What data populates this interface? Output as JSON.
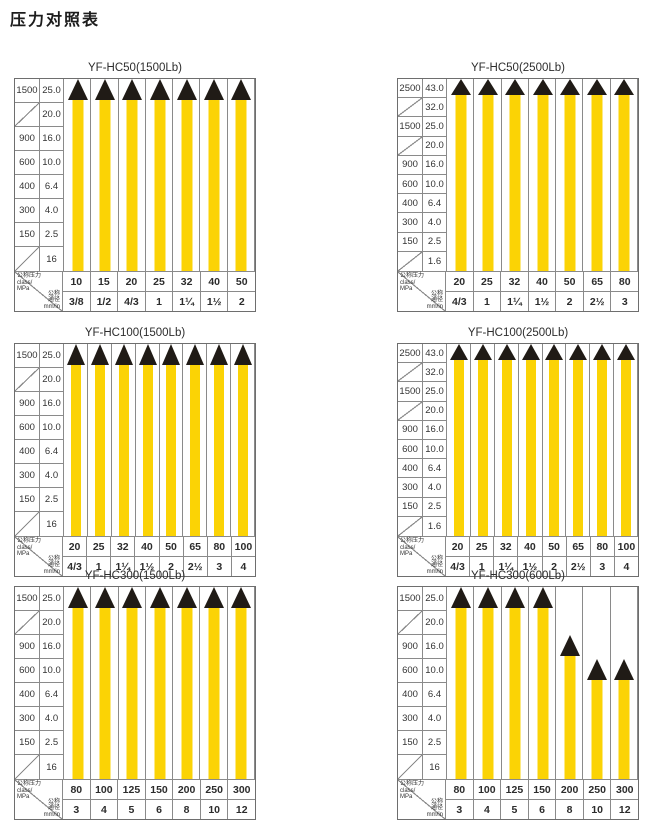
{
  "page": {
    "title": "压力对照表"
  },
  "corner": {
    "pressure_lines": [
      "公称压力",
      "class/",
      "MPa"
    ],
    "bore_lines": [
      "公称",
      "通径",
      "mm/in"
    ]
  },
  "colors": {
    "bar_yellow": "#FBD305",
    "marker_black": "#201B16",
    "grid_line": "#8A8A8A",
    "outer_border": "#6E6E6E"
  },
  "chart_data": [
    {
      "type": "bar",
      "title": "YF-HC50(1500Lb)",
      "ylabel": "公称压力 class / MPa",
      "xlabel": "公称通径 mm/in",
      "axis_rows": [
        [
          "1500",
          "25.0"
        ],
        [
          "",
          "20.0"
        ],
        [
          "900",
          "16.0"
        ],
        [
          "600",
          "10.0"
        ],
        [
          "400",
          "6.4"
        ],
        [
          "300",
          "4.0"
        ],
        [
          "150",
          "2.5"
        ],
        [
          "",
          "16"
        ]
      ],
      "categories": [
        "10",
        "15",
        "20",
        "25",
        "32",
        "40",
        "50"
      ],
      "dn_row": [
        "3/8",
        "1/2",
        "4/3",
        "1",
        "1¼",
        "1½",
        "2"
      ],
      "values_mpa": [
        25.0,
        25.0,
        25.0,
        25.0,
        25.0,
        25.0,
        25.0
      ],
      "bar_top_rows": [
        0,
        0,
        0,
        0,
        0,
        0,
        0
      ],
      "ylim": [
        0,
        25.0
      ]
    },
    {
      "type": "bar",
      "title": "YF-HC50(2500Lb)",
      "ylabel": "公称压力 class / MPa",
      "xlabel": "公称通径 mm/in",
      "axis_rows": [
        [
          "2500",
          "43.0"
        ],
        [
          "",
          "32.0"
        ],
        [
          "1500",
          "25.0"
        ],
        [
          "",
          "20.0"
        ],
        [
          "900",
          "16.0"
        ],
        [
          "600",
          "10.0"
        ],
        [
          "400",
          "6.4"
        ],
        [
          "300",
          "4.0"
        ],
        [
          "150",
          "2.5"
        ],
        [
          "",
          "1.6"
        ]
      ],
      "categories": [
        "20",
        "25",
        "32",
        "40",
        "50",
        "65",
        "80"
      ],
      "dn_row": [
        "4/3",
        "1",
        "1¼",
        "1½",
        "2",
        "2½",
        "3"
      ],
      "values_mpa": [
        43.0,
        43.0,
        43.0,
        43.0,
        43.0,
        43.0,
        43.0
      ],
      "bar_top_rows": [
        0,
        0,
        0,
        0,
        0,
        0,
        0
      ],
      "ylim": [
        0,
        43.0
      ]
    },
    {
      "type": "bar",
      "title": "YF-HC100(1500Lb)",
      "ylabel": "公称压力 class / MPa",
      "xlabel": "公称通径 mm/in",
      "axis_rows": [
        [
          "1500",
          "25.0"
        ],
        [
          "",
          "20.0"
        ],
        [
          "900",
          "16.0"
        ],
        [
          "600",
          "10.0"
        ],
        [
          "400",
          "6.4"
        ],
        [
          "300",
          "4.0"
        ],
        [
          "150",
          "2.5"
        ],
        [
          "",
          "16"
        ]
      ],
      "categories": [
        "20",
        "25",
        "32",
        "40",
        "50",
        "65",
        "80",
        "100"
      ],
      "dn_row": [
        "4/3",
        "1",
        "1¼",
        "1½",
        "2",
        "2½",
        "3",
        "4"
      ],
      "values_mpa": [
        25.0,
        25.0,
        25.0,
        25.0,
        25.0,
        25.0,
        25.0,
        25.0
      ],
      "bar_top_rows": [
        0,
        0,
        0,
        0,
        0,
        0,
        0,
        0
      ],
      "ylim": [
        0,
        25.0
      ]
    },
    {
      "type": "bar",
      "title": "YF-HC100(2500Lb)",
      "ylabel": "公称压力 class / MPa",
      "xlabel": "公称通径 mm/in",
      "axis_rows": [
        [
          "2500",
          "43.0"
        ],
        [
          "",
          "32.0"
        ],
        [
          "1500",
          "25.0"
        ],
        [
          "",
          "20.0"
        ],
        [
          "900",
          "16.0"
        ],
        [
          "600",
          "10.0"
        ],
        [
          "400",
          "6.4"
        ],
        [
          "300",
          "4.0"
        ],
        [
          "150",
          "2.5"
        ],
        [
          "",
          "1.6"
        ]
      ],
      "categories": [
        "20",
        "25",
        "32",
        "40",
        "50",
        "65",
        "80",
        "100"
      ],
      "dn_row": [
        "4/3",
        "1",
        "1¼",
        "1½",
        "2",
        "2½",
        "3",
        "4"
      ],
      "values_mpa": [
        43.0,
        43.0,
        43.0,
        43.0,
        43.0,
        43.0,
        43.0,
        43.0
      ],
      "bar_top_rows": [
        0,
        0,
        0,
        0,
        0,
        0,
        0,
        0
      ],
      "ylim": [
        0,
        43.0
      ]
    },
    {
      "type": "bar",
      "title": "YF-HC300(1500Lb)",
      "ylabel": "公称压力 class / MPa",
      "xlabel": "公称通径 mm/in",
      "axis_rows": [
        [
          "1500",
          "25.0"
        ],
        [
          "",
          "20.0"
        ],
        [
          "900",
          "16.0"
        ],
        [
          "600",
          "10.0"
        ],
        [
          "400",
          "6.4"
        ],
        [
          "300",
          "4.0"
        ],
        [
          "150",
          "2.5"
        ],
        [
          "",
          "16"
        ]
      ],
      "categories": [
        "80",
        "100",
        "125",
        "150",
        "200",
        "250",
        "300"
      ],
      "dn_row": [
        "3",
        "4",
        "5",
        "6",
        "8",
        "10",
        "12"
      ],
      "values_mpa": [
        25.0,
        25.0,
        25.0,
        25.0,
        25.0,
        25.0,
        25.0
      ],
      "bar_top_rows": [
        0,
        0,
        0,
        0,
        0,
        0,
        0
      ],
      "ylim": [
        0,
        25.0
      ]
    },
    {
      "type": "bar",
      "title": "YF-HC300(600Lb)",
      "ylabel": "公称压力 class / MPa",
      "xlabel": "公称通径 mm/in",
      "axis_rows": [
        [
          "1500",
          "25.0"
        ],
        [
          "",
          "20.0"
        ],
        [
          "900",
          "16.0"
        ],
        [
          "600",
          "10.0"
        ],
        [
          "400",
          "6.4"
        ],
        [
          "300",
          "4.0"
        ],
        [
          "150",
          "2.5"
        ],
        [
          "",
          "16"
        ]
      ],
      "categories": [
        "80",
        "100",
        "125",
        "150",
        "200",
        "250",
        "300"
      ],
      "dn_row": [
        "3",
        "4",
        "5",
        "6",
        "8",
        "10",
        "12"
      ],
      "values_mpa": [
        25.0,
        25.0,
        25.0,
        25.0,
        16.0,
        10.0,
        10.0
      ],
      "bar_top_rows": [
        0,
        0,
        0,
        0,
        2,
        3,
        3
      ],
      "ylim": [
        0,
        25.0
      ]
    }
  ]
}
